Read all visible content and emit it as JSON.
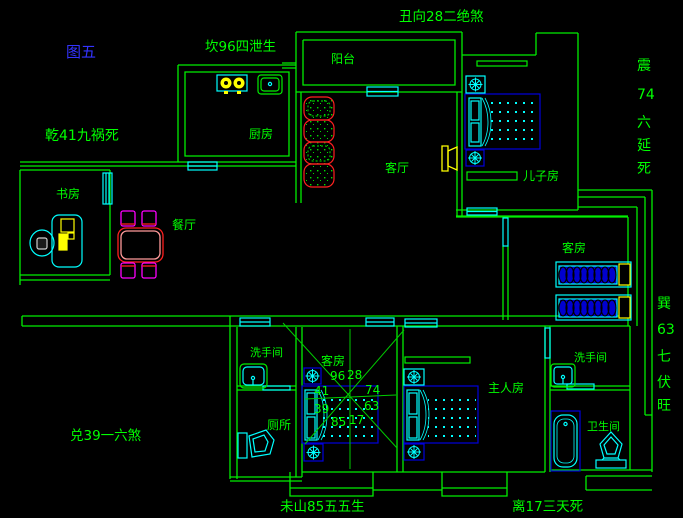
{
  "figure_label": "图五",
  "annotations": {
    "north": "坎96四泄生",
    "northeast": "丑向28二绝煞",
    "northwest": "乾41九祸死",
    "west": "兑39一六煞",
    "southwest": "未山85五五生",
    "south": "离17三天死",
    "east_vertical": [
      "震",
      "74",
      "六",
      "延",
      "死"
    ],
    "southeast_vertical": [
      "巽",
      "63",
      "七",
      "伏",
      "旺"
    ]
  },
  "rooms": {
    "balcony": "阳台",
    "kitchen": "厨房",
    "study": "书房",
    "dining": "餐厅",
    "living_room": "客厅",
    "sons_room": "儿子房",
    "guest_room_east": "客房",
    "guest_room_center": "客房",
    "washroom_west": "洗手间",
    "toilet": "厕所",
    "master_room": "主人房",
    "washroom_east": "洗手间",
    "bathroom": "卫生间"
  },
  "compass": {
    "n": "96",
    "ne": "28",
    "nw": "41",
    "e": "74",
    "w": "39",
    "se": "63",
    "sw": "85",
    "s": "17"
  },
  "colors": {
    "background": "#000000",
    "wall_green": "#00ee00",
    "label_green": "#00ff00",
    "figure_blue": "#3333ff",
    "window_cyan": "#00ffff",
    "furniture_blue": "#0000dd",
    "accent_yellow": "#ffff00",
    "accent_red": "#ff2020",
    "accent_magenta": "#ff00ff"
  }
}
